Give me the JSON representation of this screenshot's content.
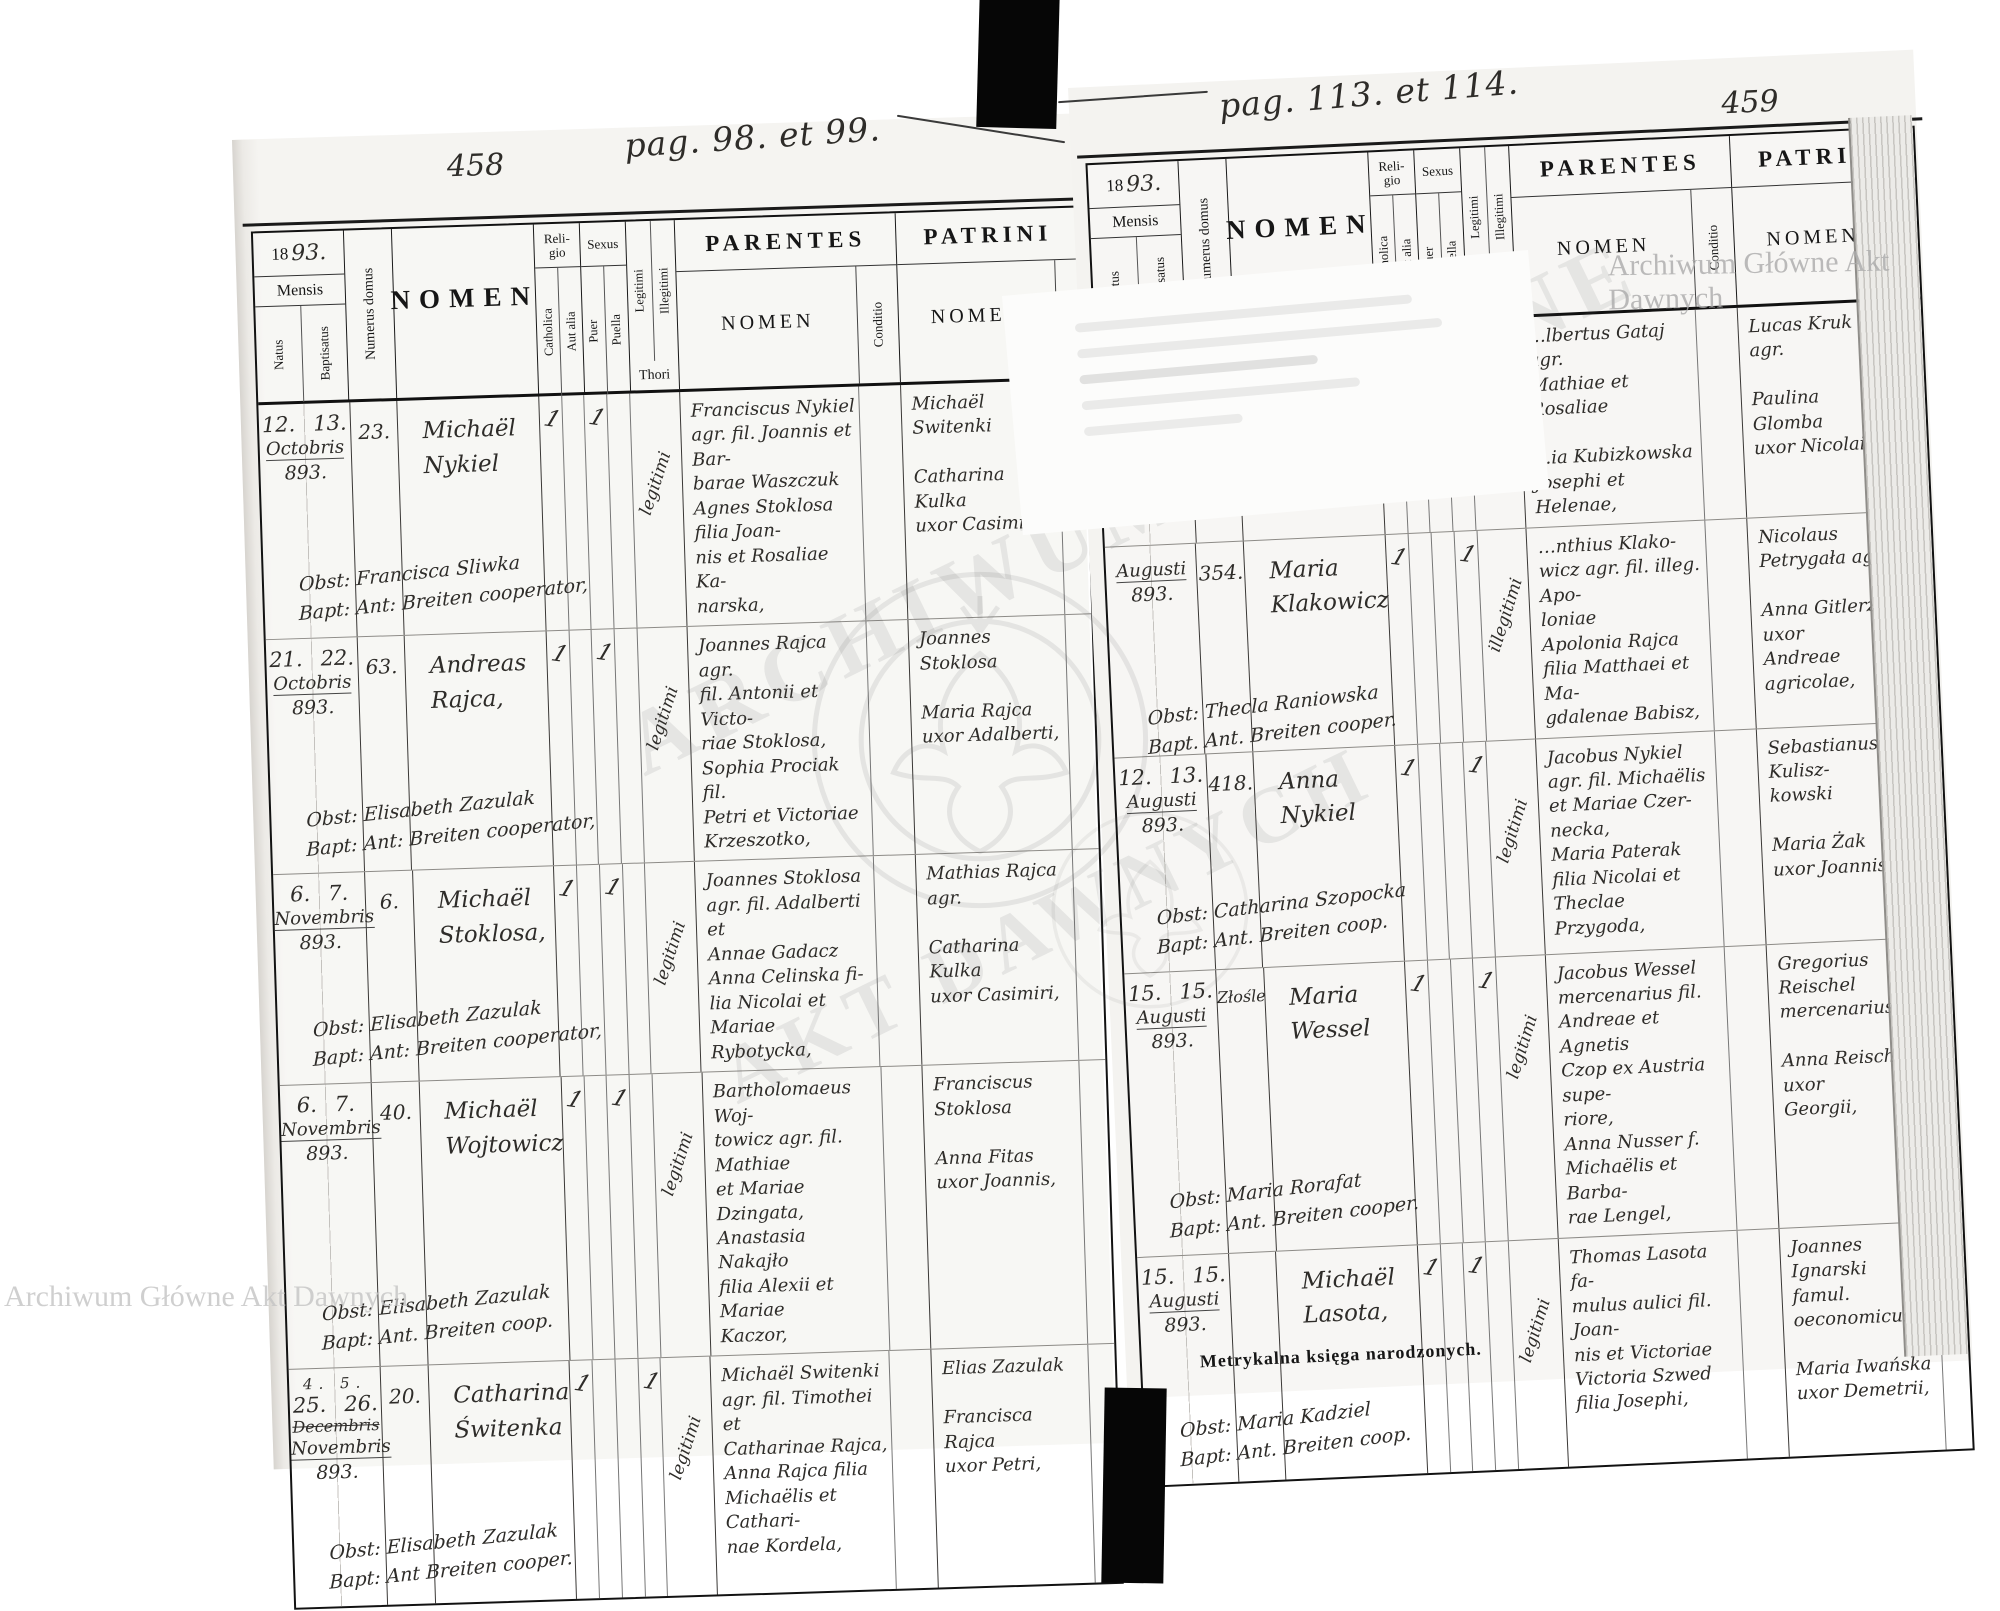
{
  "scan": {
    "left_folio": "458",
    "left_pag": "pag. 98. et 99.",
    "right_folio": "459",
    "right_pag": "pag. 113. et 114.",
    "watermark_corner": "Archiwum Główne Akt Dawnych",
    "watermark_emblem_line1": "ARCHIWUM GŁÓWNE",
    "watermark_emblem_line2": "AKT DAWNYCH",
    "caption": "Metrykalna księga narodzonych.",
    "printer": "Z drukarni J. Pawłowskiego w Tarnopolu."
  },
  "hdr": {
    "year_printed": "18",
    "year_hand": "93.",
    "mensis": "Mensis",
    "natus": "Natus",
    "baptisatus": "Baptisatus",
    "numerus": "Numerus domus",
    "nomen": "NOMEN",
    "religio": "Reli-\ngio",
    "catholica": "Catholica",
    "aut_alia": "Aut alia",
    "sexus": "Sexus",
    "puer": "Puer",
    "puella": "Puella",
    "legitimi": "Legitimi",
    "illegitimi": "Illegitimi",
    "thori": "Thori",
    "parentes": "PARENTES",
    "patrini": "PATRINI",
    "nomen2": "NOMEN",
    "conditio": "Conditio"
  },
  "left_page": {
    "records": [
      {
        "natus": "12.",
        "baptisatus": "13.",
        "month": "Octobris",
        "year": "893.",
        "house": "23.",
        "name": "Michaël\nNykiel",
        "cath": "1",
        "puer": "1",
        "puella": "",
        "thori": "legitimi",
        "note": "Obst: Francisca Sliwka\nBapt: Ant: Breiten cooperator,",
        "parents": "Franciscus Nykiel\nagr. fil. Joannis et Bar-\nbarae Waszczuk\nAgnes Stoklosa filia Joan-\nnis et Rosaliae Ka-\nnarska,",
        "patrini": "Michaël Switenki\n\nCatharina Kulka\nuxor Casimiri,"
      },
      {
        "natus": "21.",
        "baptisatus": "22.",
        "month": "Octobris",
        "year": "893.",
        "house": "63.",
        "name": "Andreas\nRajca,",
        "cath": "1",
        "puer": "1",
        "puella": "",
        "thori": "legitimi",
        "note": "Obst: Elisabeth Zazulak\nBapt: Ant: Breiten cooperator,",
        "parents": "Joannes Rajca agr.\nfil. Antonii et Victo-\nriae Stoklosa,\nSophia Prociak fil.\nPetri et Victoriae\nKrzeszotko,",
        "patrini": "Joannes Stoklosa\n\nMaria Rajca\nuxor Adalberti,"
      },
      {
        "natus": "6.",
        "baptisatus": "7.",
        "month": "Novembris",
        "year": "893.",
        "house": "6.",
        "name": "Michaël\nStoklosa,",
        "cath": "1",
        "puer": "1",
        "puella": "",
        "thori": "legitimi",
        "note": "Obst: Elisabeth Zazulak\nBapt: Ant: Breiten cooperator,",
        "parents": "Joannes Stoklosa\nagr. fil. Adalberti et\nAnnae Gadacz\nAnna Celinska fi-\nlia Nicolai et Mariae\nRybotycka,",
        "patrini": "Mathias Rajca agr.\n\nCatharina Kulka\nuxor Casimiri,"
      },
      {
        "natus": "6.",
        "baptisatus": "7.",
        "month": "Novembris",
        "year": "893.",
        "house": "40.",
        "name": "Michaël\nWojtowicz",
        "cath": "1",
        "puer": "1",
        "puella": "",
        "thori": "legitimi",
        "note": "Obst: Elisabeth Zazulak\nBapt: Ant. Breiten coop.",
        "parents": "Bartholomaeus Woj-\ntowicz agr. fil. Mathiae\net Mariae Dzingata,\nAnastasia Nakajło\nfilia Alexii et Mariae\nKaczor,",
        "patrini": "Franciscus Stoklosa\n\nAnna Fitas\nuxor Joannis,"
      },
      {
        "pre": "4. 5.",
        "natus": "25.",
        "baptisatus": "26.",
        "month_struck": "Decembris",
        "month": "Novembris",
        "year": "893.",
        "house": "20.",
        "name": "Catharina\nŚwitenka",
        "cath": "1",
        "puer": "",
        "puella": "1",
        "thori": "legitimi",
        "note": "Obst: Elisabeth Zazulak\nBapt: Ant Breiten cooper.",
        "parents": "Michaël Switenki\nagr. fil. Timothei et\nCatharinae Rajca,\nAnna Rajca filia\nMichaëlis et Cathari-\nnae Kordela,",
        "patrini": "Elias Zazulak\n\nFrancisca Rajca\nuxor Petri,"
      }
    ]
  },
  "right_page": {
    "records": [
      {
        "parents": "…lbertus Gataj agr.\nMathiae et Rosaliae\n\n…ia Kubizkowska\nJosephi et Helenae,",
        "patrini": "Lucas Kruk agr.\n\nPaulina Glomba\nuxor Nicolai,"
      },
      {
        "month": "Augusti",
        "year": "893.",
        "house": "354.",
        "name": "Maria\nKlakowicz",
        "cath": "1",
        "puer": "",
        "puella": "1",
        "thori": "illegitimi",
        "note": "Obst: Thecla Raniowska\nBapt. Ant. Breiten cooper.",
        "parents": "…nthius Klako-\nwicz agr. fil. illeg. Apo-\nloniae\nApolonia Rajca\nfilia Matthaei et Ma-\ngdalenae Babisz,",
        "patrini": "Nicolaus Petrygała agr\n\nAnna Gitlerz uxor\nAndreae agricolae,"
      },
      {
        "natus": "12.",
        "baptisatus": "13.",
        "month": "Augusti",
        "year": "893.",
        "house": "418.",
        "name": "Anna\nNykiel",
        "cath": "1",
        "puer": "",
        "puella": "1",
        "thori": "legitimi",
        "note": "Obst: Catharina Szopocka\nBapt: Ant. Breiten coop.",
        "parents": "Jacobus Nykiel\nagr. fil. Michaëlis\net Mariae Czer-\nnecka,\nMaria Paterak\nfilia Nicolai et Theclae\nPrzygoda,",
        "patrini": "Sebastianus Kulisz-\nkowski\n\nMaria Żak\nuxor Joannis,"
      },
      {
        "natus": "15.",
        "baptisatus": "15.",
        "month": "Augusti",
        "year": "893.",
        "house": "Złośle",
        "name": "Maria\nWessel",
        "cath": "1",
        "puer": "",
        "puella": "1",
        "thori": "legitimi",
        "note": "Obst: Maria Rorafat\nBapt: Ant. Breiten cooper.",
        "parents": "Jacobus Wessel\nmercenarius fil.\nAndreae et Agnetis\nCzop ex Austria supe-\nriore,\nAnna Nusser f.\nMichaëlis et Barba-\nrae Lengel,",
        "patrini": "Gregorius Reischel\nmercenarius,\n\nAnna Reischel uxor\nGeorgii,"
      },
      {
        "natus": "15.",
        "baptisatus": "15.",
        "month": "Augusti",
        "year": "893.",
        "house": "",
        "name": "Michaël\nLasota,",
        "cath": "1",
        "puer": "1",
        "puella": "",
        "thori": "legitimi",
        "note": "Obst: Maria Kadziel\nBapt: Ant. Breiten coop.",
        "parents": "Thomas Lasota fa-\nmulus aulici fil. Joan-\nnis et Victoriae\nVictoria Szwed\nfilia Josephi,",
        "patrini": "Joannes Ignarski\nfamul. oeconomicus,\n\nMaria Iwańska\nuxor Demetrii,"
      }
    ]
  }
}
